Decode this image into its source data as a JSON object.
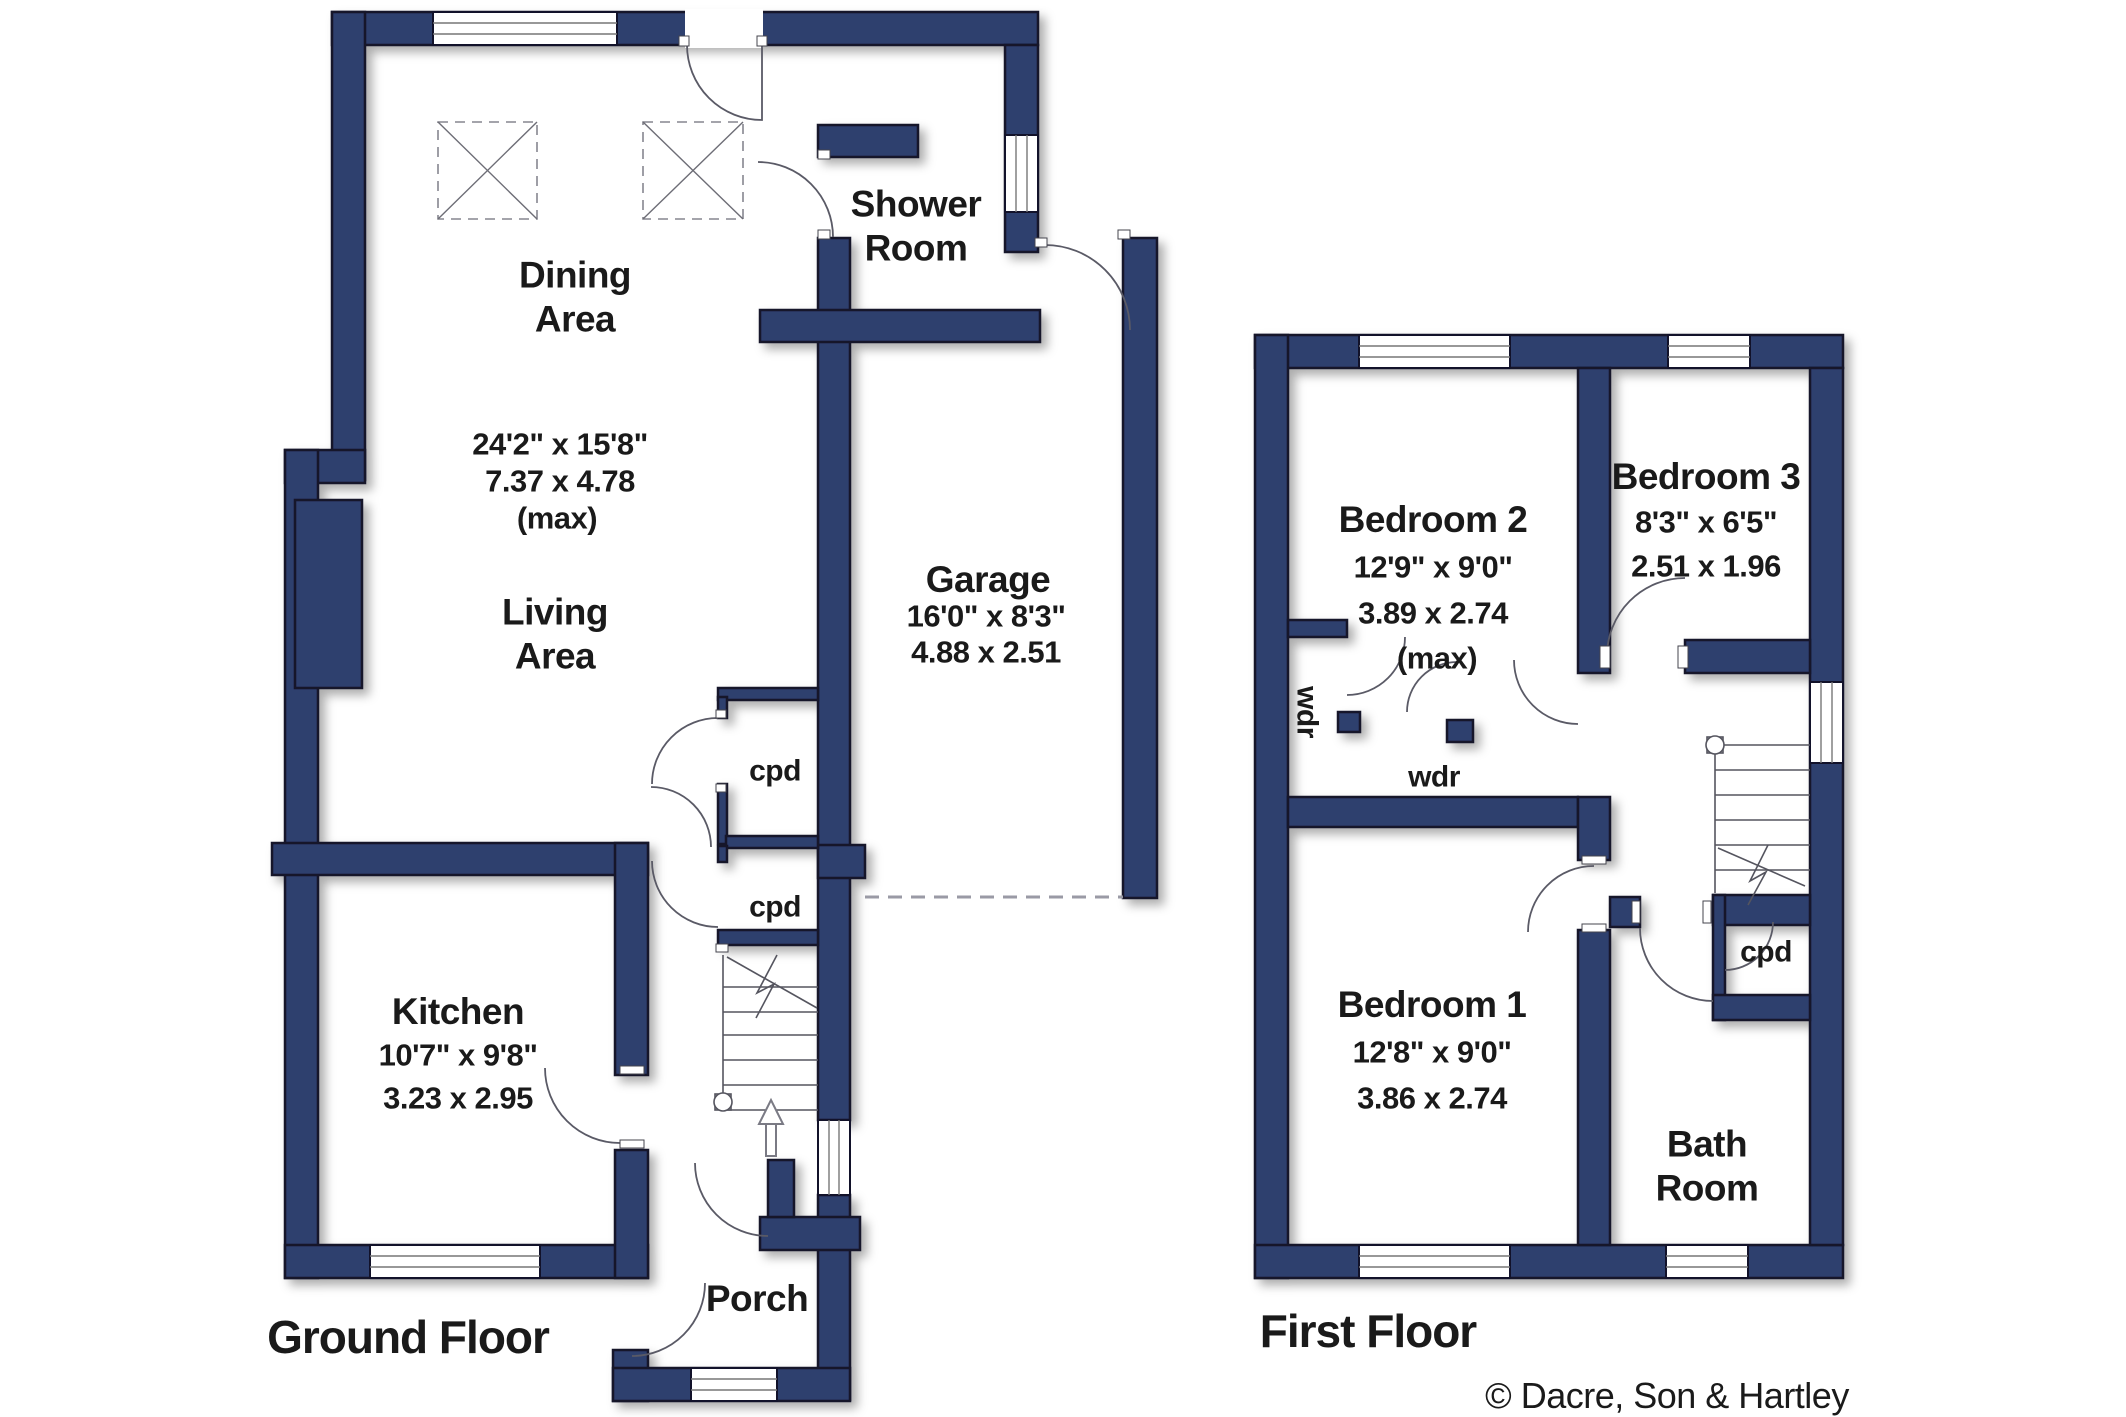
{
  "meta": {
    "copyright": "© Dacre, Son & Hartley"
  },
  "colors": {
    "wall": "#2e3f6e",
    "outline": "#12122a",
    "door_arc": "#5a5a66",
    "dashed_line": "#9a9aa5",
    "text": "#1a1a1a"
  },
  "ground_floor": {
    "title": "Ground Floor",
    "rooms": {
      "dining_area": {
        "name": "Dining Area",
        "dims_imperial": "24'2\" x 15'8\"",
        "dims_metric": "7.37 x 4.78",
        "dims_note": "(max)"
      },
      "living_area": {
        "name": "Living Area"
      },
      "shower_room": {
        "name": "Shower Room"
      },
      "garage": {
        "name": "Garage",
        "dims_imperial": "16'0\" x 8'3\"",
        "dims_metric": "4.88 x 2.51"
      },
      "kitchen": {
        "name": "Kitchen",
        "dims_imperial": "10'7\" x 9'8\"",
        "dims_metric": "3.23 x 2.95"
      },
      "cupboard_top": {
        "name": "cpd"
      },
      "cupboard_bottom": {
        "name": "cpd"
      },
      "porch": {
        "name": "Porch"
      }
    }
  },
  "first_floor": {
    "title": "First Floor",
    "rooms": {
      "bedroom_2": {
        "name": "Bedroom 2",
        "dims_imperial": "12'9\" x 9'0\"",
        "dims_metric": "3.89 x 2.74",
        "dims_note": "(max)"
      },
      "bedroom_3": {
        "name": "Bedroom 3",
        "dims_imperial": "8'3\" x 6'5\"",
        "dims_metric": "2.51 x 1.96"
      },
      "bedroom_1": {
        "name": "Bedroom 1",
        "dims_imperial": "12'8\" x 9'0\"",
        "dims_metric": "3.86 x 2.74"
      },
      "bathroom": {
        "name": "Bath Room"
      },
      "wardrobe_left": {
        "name": "wdr"
      },
      "wardrobe_middle": {
        "name": "wdr"
      },
      "cupboard": {
        "name": "cpd"
      }
    }
  }
}
